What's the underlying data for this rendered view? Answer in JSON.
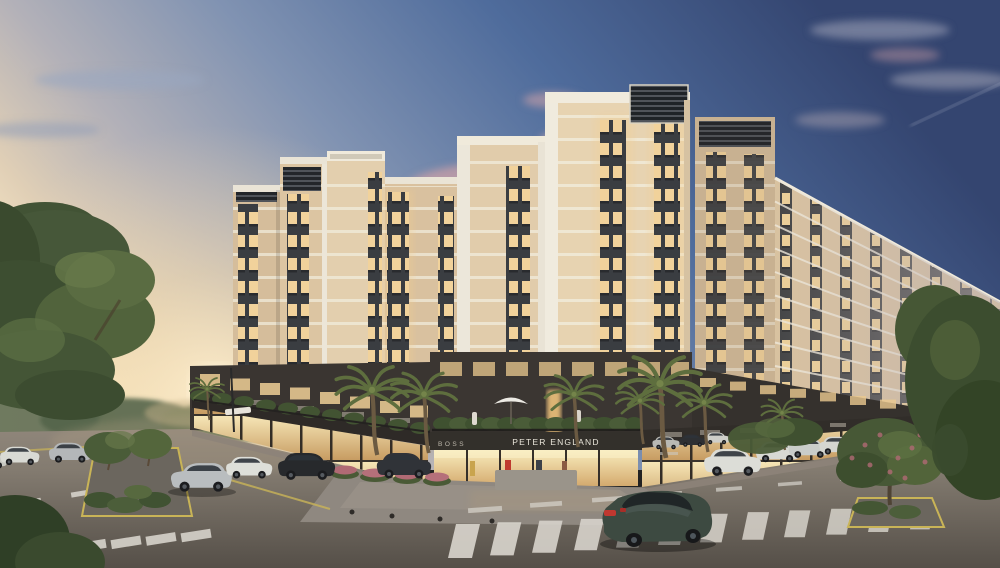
{
  "meta": {
    "title": "Apartment complex street-corner view at dusk",
    "type": "3d-architectural-rendering"
  },
  "signs": {
    "peter_england": "PETER ENGLAND",
    "boss": "BOSS"
  },
  "scene": {
    "time_of_day": "dusk",
    "sky": {
      "top_blue": "#344570",
      "mid_blue": "#8193b2",
      "horizon_glow": "#f4e3c2",
      "cloud_pink": "#c79fa8"
    },
    "buildings": {
      "facade_cream": "#e0caa8",
      "floor_band_white": "#f0ead9",
      "balcony_dark": "#3a3d41",
      "window_glow": "#f1d29b",
      "podium_charcoal": "#3b3632",
      "storefront_glass": "#f8e9ba",
      "crown_louver": "#23262a"
    },
    "street": {
      "asphalt_near": "#554f48",
      "asphalt_far": "#968c80",
      "marking_white": "#d7d3cb",
      "curb_yellow": "#c9b457",
      "plaza_paver": "#8f8880"
    },
    "vegetation": {
      "tree_green": "#46573a",
      "palm_green": "#5e6e3e",
      "hedge_green": "#425332",
      "flower_pink": "#b06a74"
    },
    "vehicles": {
      "hero_sedan_green": "#3d4a41",
      "silver": "#b9bdbf",
      "white": "#dedfd9",
      "dark": "#27292c",
      "bus_cream": "#d6d2c4",
      "taillight_red": "#c03830"
    },
    "counts": {
      "towers_visible": 7,
      "palm_trees": 8,
      "main_crosswalk_stripes": 12
    }
  }
}
